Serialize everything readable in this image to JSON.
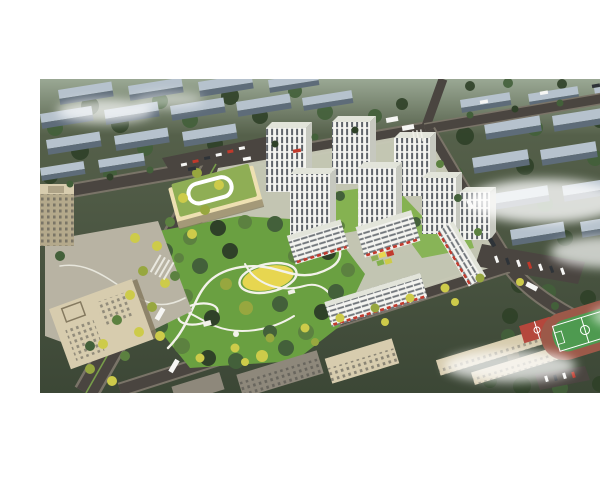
{
  "alt_text": "Aerial 3D rendering of a residential development masterplan: white high-rise apartment towers around green courtyards, a large landscaped park with winding white paths and a yellow lawn, a kindergarten with a green roof, tree-lined boulevard, beige office buildings, street-retail slabs with red awnings, a school campus with running track, sports pitch and red courts, surrounded by muted blue-gray city blocks, roads with cars and drifting white mist.",
  "scene": {
    "elements": [
      "background-city-blocks",
      "mist-clouds",
      "road-network",
      "tree-lined-boulevard",
      "central-park",
      "yellow-lawn",
      "park-paths",
      "kindergarten-green-roof",
      "residential-towers",
      "courtyard-gardens",
      "street-retail-slabs",
      "red-awnings",
      "office-buildings",
      "plaza",
      "parking-lots",
      "school-campus",
      "running-track",
      "sports-pitch",
      "basketball-courts",
      "street-trees",
      "vehicles"
    ]
  },
  "palette": {
    "page": "#ffffff",
    "base1": "#55604a",
    "base2": "#3c4736",
    "haze": "#9aa894",
    "roofBlue": "#b6c2cd",
    "faceBlue": "#5e6c79",
    "road": "#4a4540",
    "roadEdge": "#7a7468",
    "paving": "#c9cbb8",
    "park": "#6aa041",
    "parkLight": "#82b14c",
    "lawnYellow": "#e7d650",
    "treeDark": "#2f4128",
    "treeMid": "#43603a",
    "treeLight": "#5c8140",
    "treeYellow": "#cdcb4a",
    "treeOlive": "#97a73f",
    "path": "#f3f2ea",
    "towerFace": "#f4f4f0",
    "towerSide": "#c6c8bf",
    "towerRoof": "#e2e4da",
    "win": "#394049",
    "beigeRoof": "#d7ccae",
    "beigeFace": "#b4a98b",
    "beigeDark": "#857a60",
    "plaza": "#b8b3a3",
    "kRoof": "#8fae55",
    "kWall": "#eee0b2",
    "awning": "#c23b2e",
    "track": "#9c5949",
    "pitch": "#4e9a50",
    "court": "#b5473c",
    "mist": "#ffffff",
    "carWhite": "#f6f6f4",
    "carDark": "#2e3338",
    "carRed": "#c0392b",
    "darkSlab": "#8e887b",
    "winDark": "#4a4a46"
  }
}
